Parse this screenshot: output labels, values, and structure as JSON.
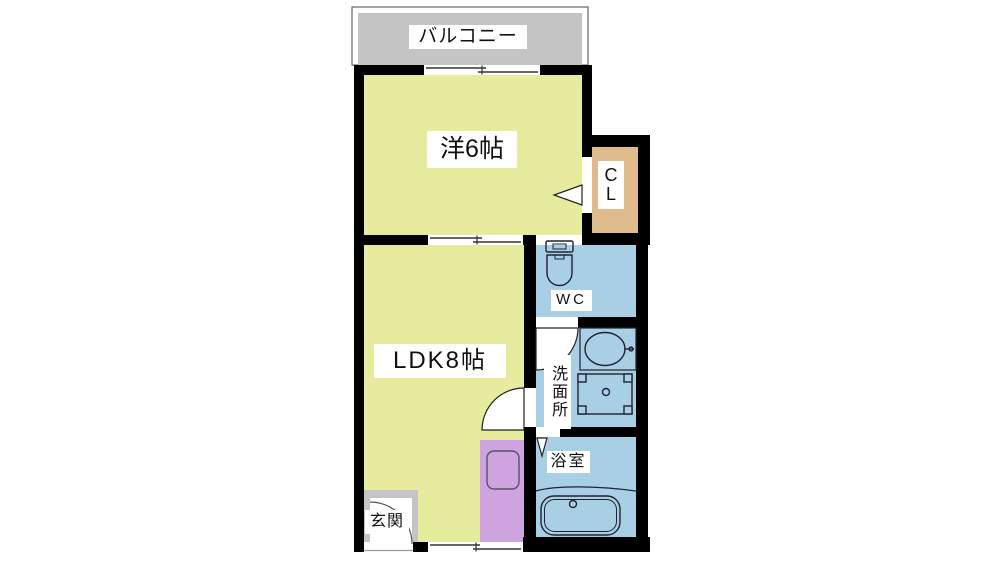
{
  "page": {
    "type": "apartment-floor-plan"
  },
  "rooms": {
    "balcony": {
      "label": "バルコニー"
    },
    "western_room": {
      "label": "洋6帖"
    },
    "closet": {
      "label_line1": "C",
      "label_line2": "L"
    },
    "ldk": {
      "label": "LDK8帖"
    },
    "wc": {
      "label": "WC"
    },
    "washroom": {
      "label": "洗面所"
    },
    "bathroom": {
      "label": "浴室"
    },
    "entrance": {
      "label": "玄関"
    }
  },
  "colors": {
    "wall": "#000000",
    "room_yellow": "#e7eb9e",
    "wet_area_blue": "#a9cfe5",
    "closet_tan": "#dfba8c",
    "kitchen_purple": "#cda4df",
    "balcony_gray": "#c4c4c4",
    "label_background": "#ffffff",
    "label_text": "#111111"
  },
  "icons": {
    "toilet": "toilet-icon",
    "washbasin": "sink-icon",
    "washing_machine": "washing-machine-icon",
    "bathtub": "bathtub-icon",
    "kitchen_sink": "kitchen-sink-icon",
    "door_swing": "door-arc-icon",
    "folding_door": "folding-door-icon",
    "sliding_window": "window-symbol"
  }
}
